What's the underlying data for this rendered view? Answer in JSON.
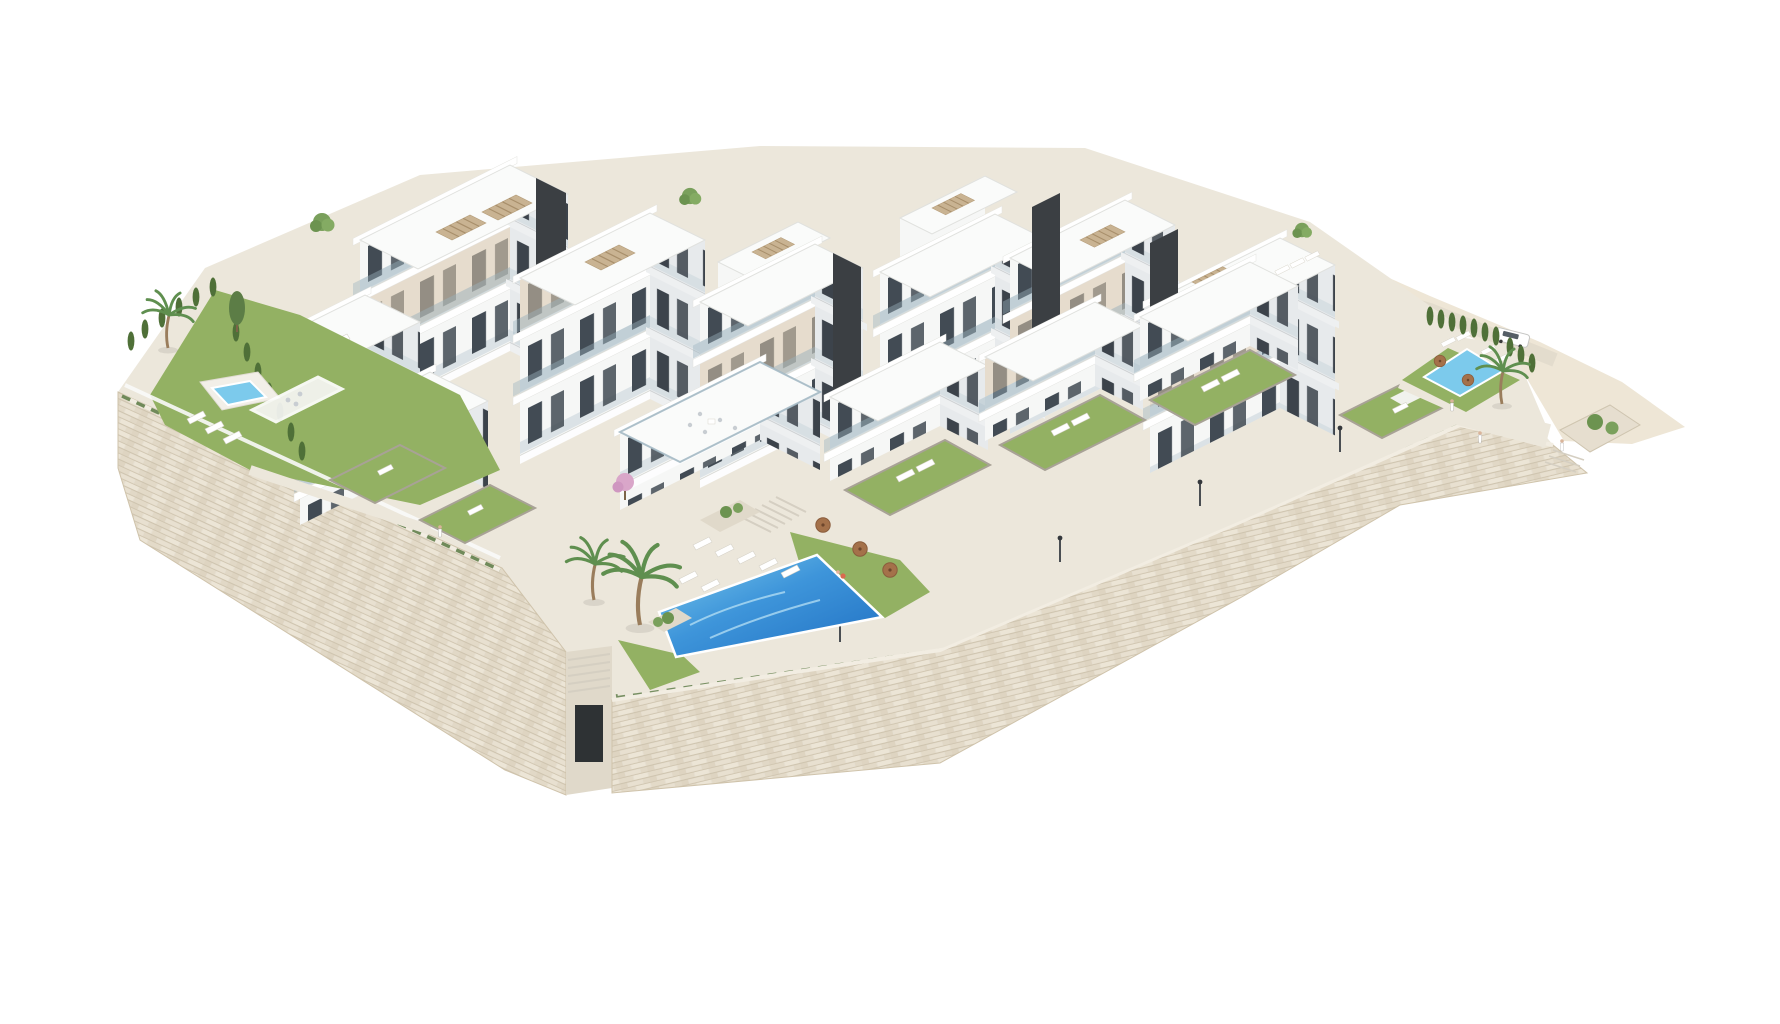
{
  "image": {
    "kind": "architectural-3d-render",
    "alt": "Aerial 3D architectural rendering of a modern white hillside apartment complex on a stone-clad podium, with stepped terraces, landscaped gardens, palm trees, three swimming pools, sun loungers, parasols and a parked car, on a plain white background"
  },
  "palette": {
    "background": "#ffffff",
    "white-face": "#f6f7f6",
    "shade-face": "#e7eaec",
    "roof": "#fafbfa",
    "beige": "#d8c7ab",
    "beige-dark": "#c9b392",
    "charcoal": "#3b3f43",
    "window": "#424b54",
    "glass": "#9db5c2",
    "stone": "#e6dfd1",
    "stone-dark": "#d9cfbd",
    "pave": "#ece7db",
    "pave-dark": "#e0d9ca",
    "grass": "#93b163",
    "grass-dark": "#7d9a50",
    "hedge": "#4f7038",
    "pool-deep": "#1f6fc2",
    "pool-light": "#7ccaec",
    "terrain": "#eee6d6",
    "umbrella": "#a4714a",
    "trunk": "#9a7d5c",
    "palm": "#5f8f4f",
    "lamp": "#4a4e52",
    "pink-tree": "#d9a6c9"
  },
  "scene": {
    "setting": "hillside residential development above dry-stone retaining walls",
    "elements": {
      "apartment_blocks": 9,
      "swimming_pools": 3,
      "rooftop_pergolas": 6,
      "charcoal_stair_cores": 4,
      "palm_trees": 5,
      "private_lawn_terraces": 6,
      "street_lamps": 6,
      "parked_cars": 1,
      "parasols": 5,
      "people": 4
    },
    "materials": [
      "white render facades",
      "beige timber panels",
      "charcoal stair cores",
      "glass balustrades",
      "dry-stone retaining walls",
      "cypress hedges"
    ]
  }
}
